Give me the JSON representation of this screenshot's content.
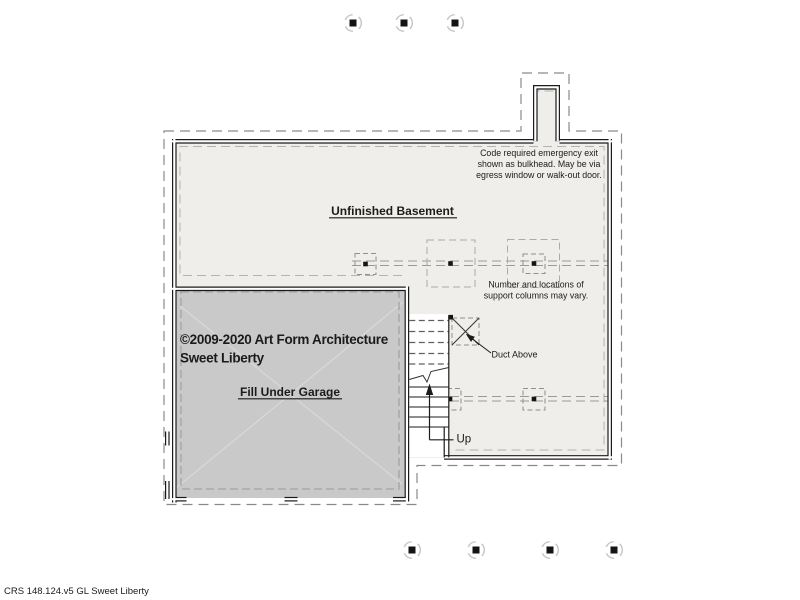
{
  "drawing": {
    "labels": {
      "basement": "Unfinished Basement",
      "garage": "Fill Under Garage",
      "up": "Up",
      "duct": "Duct Above"
    },
    "notes": {
      "emergency_exit": [
        "Code required emergency exit",
        "shown as bulkhead. May be via",
        "egress window or walk-out door."
      ],
      "columns": [
        "Number and locations of",
        "support columns may vary."
      ]
    },
    "copyright": {
      "line1": "©2009-2020 Art Form Architecture",
      "line2": "Sweet Liberty"
    },
    "sheet_code": "CRS 148.124.v5 GL Sweet Liberty",
    "colors": {
      "basement_fill": "#f0eeeb",
      "garage_fill": "#c9c9c9",
      "wall": "#1b1b1b",
      "dashed_outline": "#8a8a8a",
      "footer_text": "#d9d9d9"
    }
  }
}
